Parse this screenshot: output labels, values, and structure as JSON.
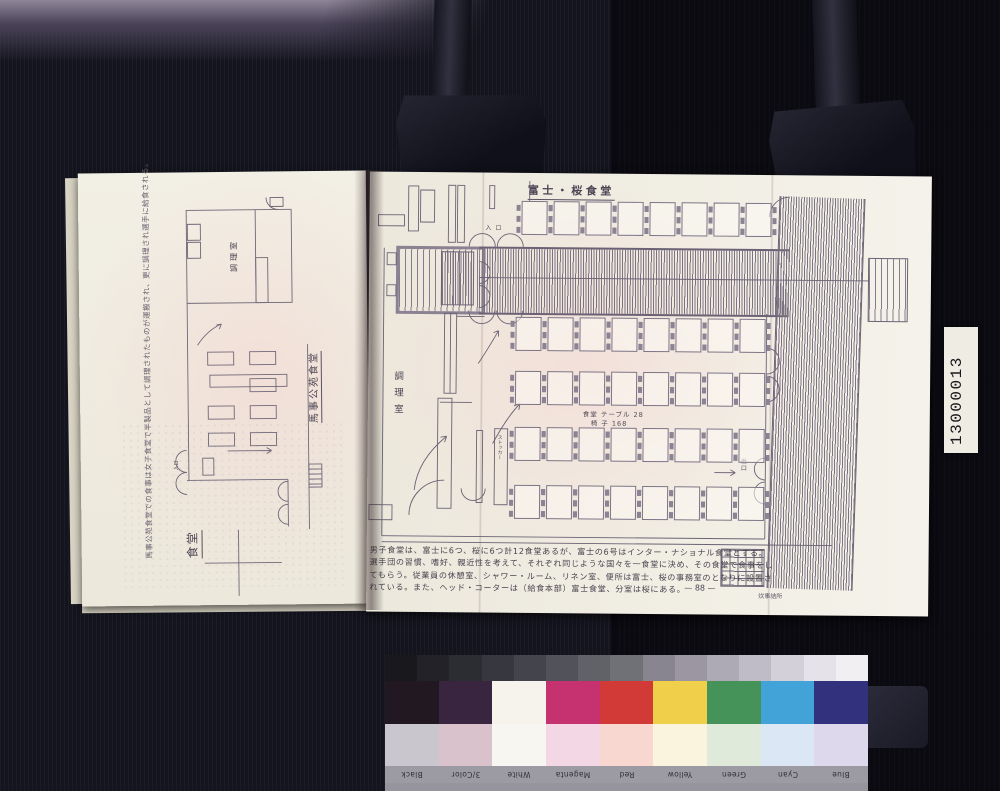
{
  "photo": {
    "id_label": "13000013",
    "kodak": {
      "brand": "Kodak Color Control Patches",
      "copyright": "© Kodak, 2007 TM: Kodak",
      "patches": [
        {
          "label": "Black",
          "color": "#211822",
          "pastel": "#c9c7cd"
        },
        {
          "label": "3/Color",
          "color": "#3a2540",
          "pastel": "#d9c2cc"
        },
        {
          "label": "White",
          "color": "#f5f3ec",
          "pastel": "#f8f6f1"
        },
        {
          "label": "Magenta",
          "color": "#c6326f",
          "pastel": "#f3d7e4"
        },
        {
          "label": "Red",
          "color": "#d13a36",
          "pastel": "#f7d7d0"
        },
        {
          "label": "Yellow",
          "color": "#f0d04a",
          "pastel": "#faf4de"
        },
        {
          "label": "Green",
          "color": "#46935a",
          "pastel": "#dfeadb"
        },
        {
          "label": "Cyan",
          "color": "#42a3d9",
          "pastel": "#dbe7f5"
        },
        {
          "label": "Blue",
          "color": "#31317e",
          "pastel": "#ddd8ec"
        }
      ],
      "grayscale": [
        "#19191d",
        "#222228",
        "#2c2c33",
        "#37373f",
        "#44444c",
        "#52525a",
        "#616168",
        "#707077",
        "#898590",
        "#9b96a2",
        "#ada9b5",
        "#c0bcc7",
        "#d3d0d9",
        "#e5e3e9",
        "#f1eff2"
      ]
    }
  },
  "left_page": {
    "caption": "馬事公苑食堂での食事は女子食堂で半製品として調理されたものが運搬され、更に調理され選手に給食される。",
    "plan_title": "馬事公苑食堂",
    "kitchen_label": "調理室",
    "dining_label": "食堂",
    "entrance_label": "入口"
  },
  "right_page": {
    "plan_title": "富士・桜食堂",
    "kitchen_label": "調理室",
    "counts_line1": "食堂 テーブル 28",
    "counts_line2": "椅 子 168",
    "entrance_label": "入 口",
    "exit_label": "出口",
    "stocker_label": "ストッカー",
    "annex_label": "炊事詰所",
    "page_number": "— 88 —",
    "body_lines": [
      "男子食堂は、富士に6つ、桜に6つ計12食堂あるが、富士の6号はインター・ナショナル食堂とする。",
      "選手団の習慣、嗜好、親近性を考えて、それぞれ同じような国々を一食堂に決め、その食堂で食事をし",
      "てもらう。従業員の休憩室、シャワー・ルーム、リネン室、便所は富士、桜の事務室のとなりに設置さ",
      "れている。また、ヘッド・コーターは（給食本部）富士食堂、分室は桜にある。"
    ],
    "tables": {
      "top_row": 8,
      "grid_rows": 4,
      "grid_cols": 8
    }
  }
}
